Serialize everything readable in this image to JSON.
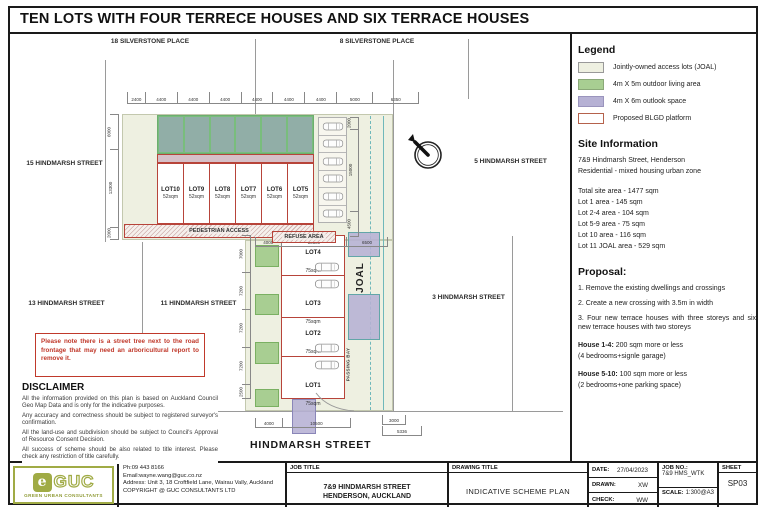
{
  "title": "TEN LOTS WITH FOUR TERRECE HOUSES AND SIX TERRACE HOUSES",
  "plan": {
    "streets": {
      "silverstone_18": "18 SILVERSTONE PLACE",
      "silverstone_8": "8 SILVERSTONE PLACE",
      "hindmarsh_15": "15 HINDMARSH STREET",
      "hindmarsh_5": "5 HINDMARSH STREET",
      "hindmarsh_13": "13 HINDMARSH STREET",
      "hindmarsh_11": "11 HINDMARSH STREET",
      "hindmarsh_3": "3 HINDMARSH STREET",
      "hindmarsh_main": "HINDMARSH STREET"
    },
    "top_lots": [
      {
        "name": "LOT10",
        "area": "52sqm"
      },
      {
        "name": "LOT9",
        "area": "52sqm"
      },
      {
        "name": "LOT8",
        "area": "52sqm"
      },
      {
        "name": "LOT7",
        "area": "52sqm"
      },
      {
        "name": "LOT6",
        "area": "52sqm"
      },
      {
        "name": "LOT5",
        "area": "52sqm"
      }
    ],
    "bottom_lots": [
      {
        "name": "LOT4",
        "area": "75sqm"
      },
      {
        "name": "LOT3",
        "area": "75sqm"
      },
      {
        "name": "LOT2",
        "area": "75sqm"
      },
      {
        "name": "LOT1",
        "area": "75sqm"
      }
    ],
    "labels": {
      "pedestrian": "PEDESTRIAN ACCESS",
      "refuse": "REFUSE AREA",
      "joal": "JOAL",
      "passing_bay": "PASSING BAY"
    },
    "parking_spaces": 6,
    "dims": {
      "top": [
        "2400",
        "4400",
        "4400",
        "4400",
        "4400",
        "4400",
        "4400",
        "5000",
        "6350"
      ],
      "left_upper": [
        "6000",
        "13300",
        "2000"
      ],
      "right_upper": [
        "2000",
        "15000",
        "4500"
      ],
      "left_lower": [
        "7000",
        "7200",
        "7200",
        "7200",
        "2500"
      ],
      "mid": [
        "4000",
        "10500",
        "6500"
      ],
      "bottom": [
        "4000",
        "10500"
      ],
      "crossing_width": [
        "3000"
      ],
      "crossing_offset": [
        "5336"
      ]
    }
  },
  "note": "Please note there is a street tree next to the road frontage that may need an arboricultural report to remove it.",
  "disclaimer": {
    "heading": "DISCLAIMER",
    "paragraphs": [
      "All the information provided on this plan is based on Auckland Council Geo Map Data and is only for the indicative purposes.",
      "Any accuracy and correctness should be subject to registered surveyor's confirmation.",
      "All the land-use and subdivision should be subject to Council's Approval of Resource Consent Decision.",
      "All success of scheme should be also related to title interest. Please check any restriction of title carefully."
    ]
  },
  "legend": {
    "heading": "Legend",
    "items": [
      {
        "label": "Jointly-owned access lots (JOAL)",
        "color": "#eef0e1"
      },
      {
        "label": "4m X 5m outdoor living area",
        "color": "#a8ce92"
      },
      {
        "label": "4m X 6m outlook space",
        "color": "#b6b1d4"
      },
      {
        "label": "Proposed BLGD platform",
        "color": "#ffffff",
        "border": "#b5624c"
      }
    ]
  },
  "site_info": {
    "heading": "Site Information",
    "address": [
      "7&9 Hindmarsh Street, Henderson",
      "Residential - mixed housing urban zone"
    ],
    "areas": [
      "Total site area - 1477 sqm",
      "Lot 1 area - 145 sqm",
      "Lot 2-4 area - 104 sqm",
      "Lot 5-9 area - 75 sqm",
      "Lot 10 area - 116 sqm",
      "Lot 11 JOAL area - 529 sqm"
    ]
  },
  "proposal": {
    "heading": "Proposal:",
    "items": [
      "1. Remove the existing dwellings and crossings",
      "2. Create a new crossing with 3.5m in width",
      "3. Four new terrace houses with three storeys and six new terrace houses with two storeys"
    ],
    "houses": [
      {
        "name": "House 1-4:",
        "desc": "200 sqm more or less",
        "sub": "(4 bedrooms+signle garage)"
      },
      {
        "name": "House 5-10:",
        "desc": "100 sqm more or less",
        "sub": "(2 bedrooms+one parking space)"
      }
    ]
  },
  "title_block": {
    "logo_text": "GUC",
    "logo_tagline": "GREEN URBAN CONSULTANTS",
    "contact": [
      "Ph:09 443 8166",
      "Email:wayne.wang@guc.co.nz",
      "Address: Unit 3, 18 Croftfield Lane, Wairau Vally, Auckland",
      "COPYRIGHT @ GUC CONSULTANTS LTD"
    ],
    "job_title_label": "JOB TITLE",
    "job_title_line1": "7&9 HINDMARSH STREET",
    "job_title_line2": "HENDERSON, AUCKLAND",
    "drawing_title_label": "DRAWING TITLE",
    "drawing_title": "INDICATIVE SCHEME PLAN",
    "date_label": "DATE:",
    "date": "27/04/2023",
    "drawn_label": "DRAWN:",
    "drawn": "XW",
    "check_label": "CHECK:",
    "check": "WW",
    "job_no_label": "JOB NO.:",
    "job_no": "7&9 HMS_WTK",
    "scale_label": "SCALE:",
    "scale": "1:300@A3",
    "sheet_label": "SHEET",
    "sheet": "SP03"
  }
}
